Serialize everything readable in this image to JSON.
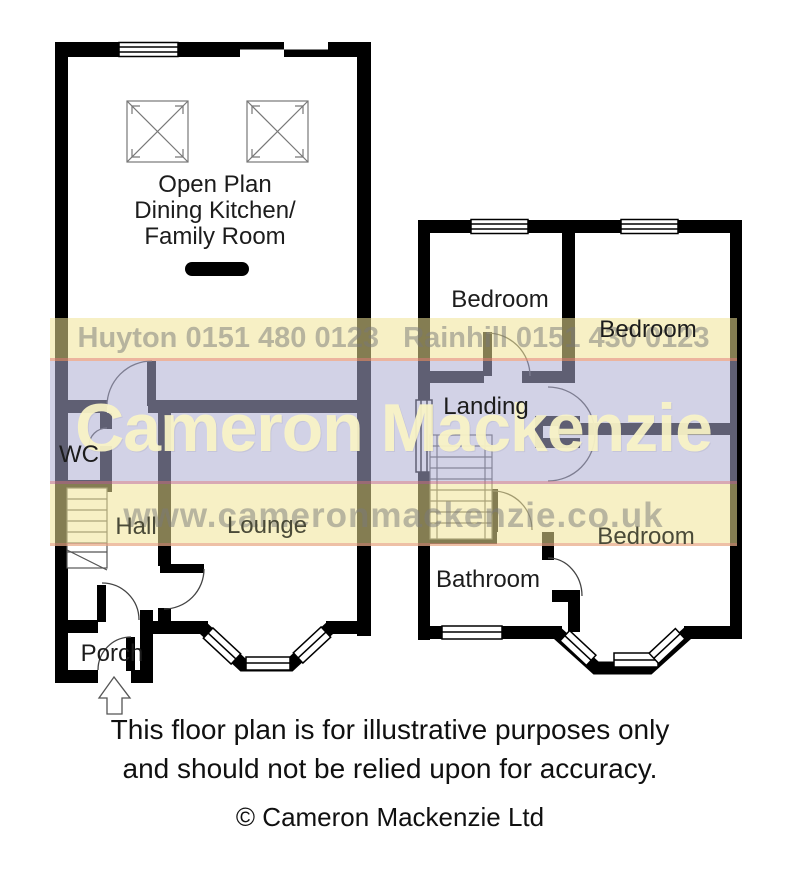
{
  "watermark": {
    "offices": "Huyton 0151 480 0123   Rainhill 0151 430 0123",
    "brand": "Cameron Mackenzie",
    "website": "www.cameronmackenzie.co.uk"
  },
  "rooms": {
    "open_plan_line1": "Open Plan",
    "open_plan_line2": "Dining Kitchen/",
    "open_plan_line3": "Family Room",
    "wc": "WC",
    "hall": "Hall",
    "lounge": "Lounge",
    "porch": "Porch",
    "bedroom_front": "Bedroom",
    "bedroom_rear": "Bedroom",
    "landing": "Landing",
    "bedroom_bottom": "Bedroom",
    "bathroom": "Bathroom"
  },
  "footer": {
    "disclaimer_line1": "This floor plan is for illustrative purposes only",
    "disclaimer_line2": "and should not be relied upon for accuracy.",
    "copyright": "© Cameron Mackenzie Ltd"
  },
  "colors": {
    "wall": "#000000",
    "band_yellow": "#f2e496",
    "band_lavender": "#adadd1",
    "brand_text": "#faf4c6",
    "divider_pink": "#e17878"
  }
}
